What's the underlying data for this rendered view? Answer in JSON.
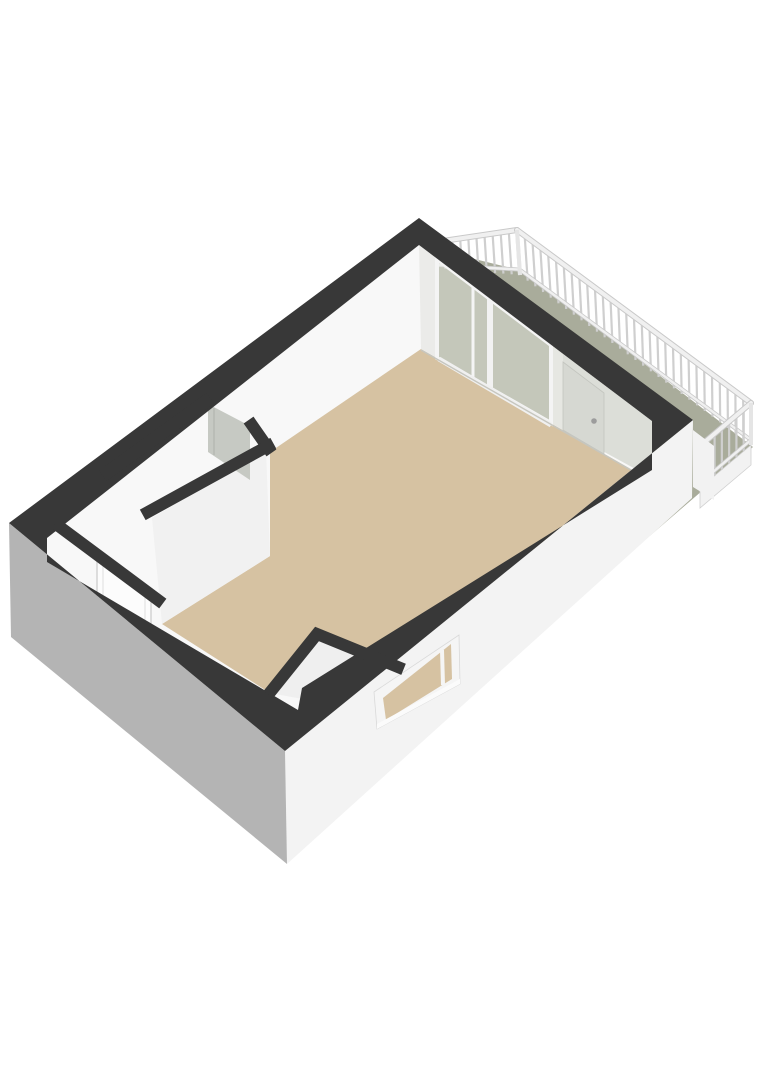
{
  "scene": {
    "type": "3d-floorplan-render",
    "rooms": [
      {
        "name": "living-room",
        "floor_color": "#d6c2a2"
      },
      {
        "name": "hall",
        "floor_color": "#f8f8f8"
      },
      {
        "name": "balcony",
        "floor_color": "#a9ac9b"
      }
    ],
    "features": [
      {
        "name": "balcony-balustrade",
        "description": "white spindle railing on three balcony edges"
      },
      {
        "name": "sliding-glass-door",
        "description": "glazed sliding door between living room and balcony"
      },
      {
        "name": "balcony-door",
        "description": "single door with handle to balcony"
      },
      {
        "name": "interior-doorway-open-door",
        "description": "doorway in hall partition with gray open door"
      },
      {
        "name": "hall-door",
        "description": "white interior door in hall"
      },
      {
        "name": "window",
        "description": "low wide window in lower-right exterior wall"
      },
      {
        "name": "corner-shaft",
        "description": "small enclosed shaft at south corner"
      }
    ]
  },
  "colors": {
    "background": "#ffffff",
    "wallTop": "#383838",
    "wallExtShade": "#b4b4b4",
    "wallExtLight": "#f3f3f3",
    "wallInterior": "#f8f8f8",
    "glazWall": "#dcded8",
    "cornerPillar": "#ebebe9",
    "wallSeg": "#e6e7e2",
    "doorLeaf": "#d6d8d2",
    "doorHandle": "#9c9c9c",
    "grayDoor": "#c6c9c3",
    "hallDoor": "#fcfcfc",
    "doorFrameLine": "#c9c9c9",
    "floorMain": "#d6c2a2",
    "floorBalcony": "#a9ac9b",
    "glassTint": "#e9ece4",
    "frameWhite": "#f5f5f5",
    "sill": "#fbfbfb",
    "fascia": "#f2f2f2",
    "fasciaEdge": "#cfcfcf",
    "notchFace": "#efefef",
    "p2Face": "#f1f1f1",
    "baseShadow": "#c6c6bf",
    "railPost": "#cfcfcf",
    "railLight": "#f0f0f0",
    "railEdge": "#c9c9c9",
    "railCorner": "#e5e5e5"
  }
}
